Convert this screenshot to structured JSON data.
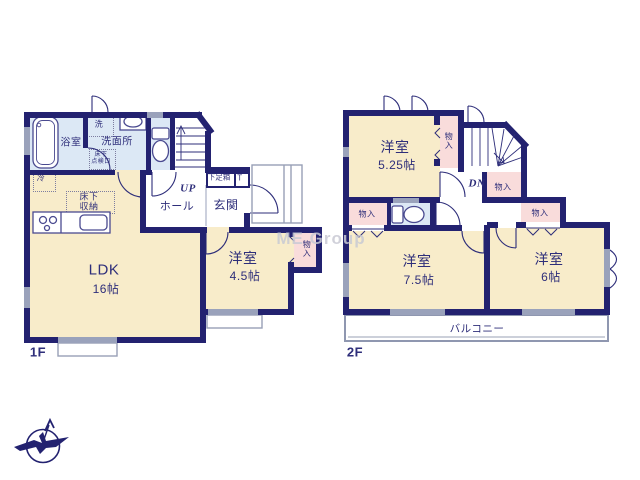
{
  "watermark": "ME Group",
  "colors": {
    "wall": "#232270",
    "room_cream": "#f8ecca",
    "closet_pink": "#f9dcdb",
    "wet_area_blue": "#dce8f5",
    "window_gray": "#9aa2bb",
    "text_navy": "#2e2e7a"
  },
  "f1": {
    "floor_label": "1F",
    "ldk": {
      "name": "LDK",
      "area": "16帖"
    },
    "bedroom": {
      "name": "洋室",
      "area": "4.5帖"
    },
    "bathroom": "浴室",
    "washroom": "洗面所",
    "laundry": "洗",
    "inspection_hatch": "床下\n点検口",
    "fridge": "冷",
    "underfloor_storage": "床下\n収納",
    "hall": "ホール",
    "entrance": "玄関",
    "shoe_box": "下足箱",
    "shoe_box_t": "T",
    "stairs_up": "UP",
    "closet": "物\n入"
  },
  "f2": {
    "floor_label": "2F",
    "bedroom_525": {
      "name": "洋室",
      "area": "5.25帖"
    },
    "bedroom_75": {
      "name": "洋室",
      "area": "7.5帖"
    },
    "bedroom_6": {
      "name": "洋室",
      "area": "6帖"
    },
    "balcony": "バルコニー",
    "stairs_down": "DN",
    "closet_a": "物\n入",
    "closet_b": "物入",
    "closet_c": "物入",
    "closet_d": "物入"
  }
}
